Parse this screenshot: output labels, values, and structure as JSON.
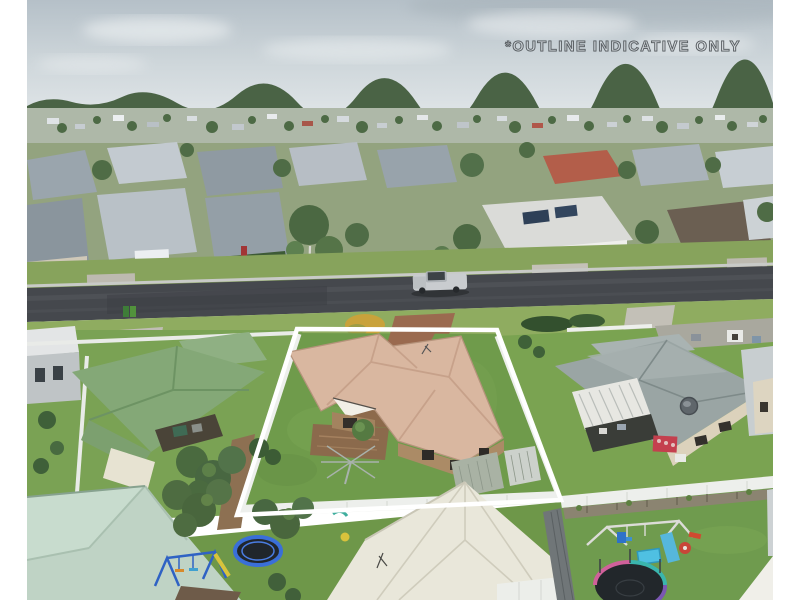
{
  "watermark": {
    "text": "*OUTLINE INDICATIVE ONLY"
  },
  "photo": {
    "subject": "aerial view of suburban street with featured property outlined in white",
    "margin_color": "#ffffff"
  },
  "colors": {
    "outline": "#ffffff",
    "sky_top": "#b5c0c8",
    "sky_bottom": "#e0e5e8",
    "road": "#45484d",
    "featured_roof": "#d9b7a0",
    "featured_lawn": "#6f9b4b",
    "left_house_roof": "#84a877",
    "right_house_roof": "#9aa5a4",
    "mint_roof": "#bfd3c5",
    "cream_roof": "#e9e7da",
    "white_fence": "#edefec",
    "watermark_stroke": "#4d5357"
  }
}
